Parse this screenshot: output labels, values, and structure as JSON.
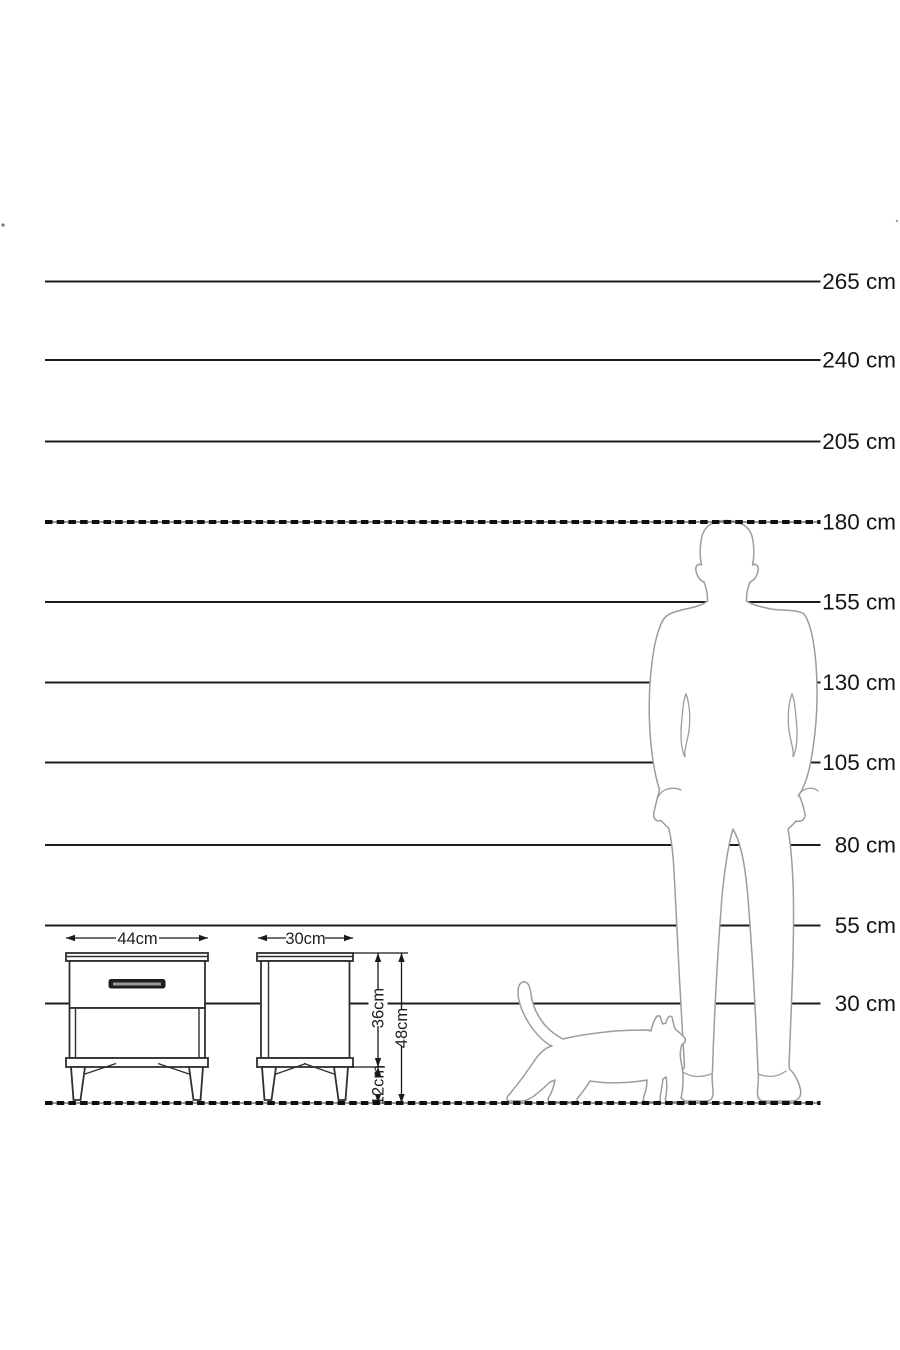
{
  "diagram_type": "furniture-dimension-height-scale",
  "colors": {
    "background": "#ffffff",
    "ruler_line": "#1c1c1c",
    "label_text": "#151515",
    "silhouette_outline": "#9c9c9c",
    "furniture_outline": "#2f2f2f",
    "handle_fill": "#1f1f1f"
  },
  "ruler": {
    "unit": "cm",
    "labels": [
      "265 cm",
      "240 cm",
      "205 cm",
      "180 cm",
      "155 cm",
      "130 cm",
      "105 cm",
      "80 cm",
      "55 cm",
      "30 cm"
    ],
    "values_cm": [
      265,
      240,
      205,
      180,
      155,
      130,
      105,
      80,
      55,
      30
    ],
    "dashed_reference_cm": 180,
    "ground_cm": 0
  },
  "dims": {
    "front_width": "44cm",
    "side_depth": "30cm",
    "body_height": "36cm",
    "leg_height": "12cm",
    "total_height": "48cm"
  }
}
